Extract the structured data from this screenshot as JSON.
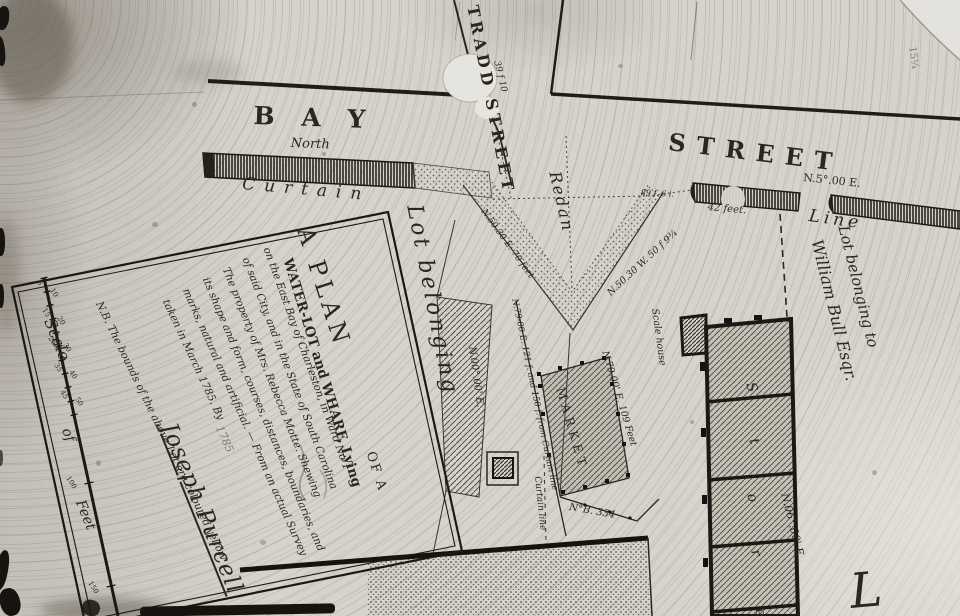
{
  "streets": {
    "bay": "B A Y",
    "bay_north": "North",
    "street": "STREET",
    "tradd": "TRADD STREET",
    "tradd_dim": "39 f 10",
    "curtain": "Curtain",
    "redan": "Redan",
    "line_word": "Line"
  },
  "bearings": {
    "n5e": "N.5°.00 E.",
    "feet42": "42 feet.",
    "feet89": "89 f. 6 i.",
    "redan_left": "N.50.30 E. 70 feet",
    "redan_right": "N.50.30 W. 50 f 9¾",
    "n79_121": "N.79-00 E. 121 f. and 150 f. from Curtain line",
    "n0": "N.00°.00' E.",
    "n79_109": "N.79.00' E. 109 Feet",
    "nb334": "N°B. 334",
    "n6e": "N.06°.00' E.",
    "curtain_line": "Curtain line"
  },
  "lots": {
    "lot_belonging": "Lot belonging",
    "william_1": "Lot belonging to",
    "william_2": "William Bull Esqr.",
    "market": "MARKET",
    "scale_house": "Scale house",
    "store_letters": [
      "S",
      "t",
      "o",
      "r",
      "e"
    ],
    "big_letter": "L"
  },
  "cartouche": {
    "title": "A PLAN",
    "title2": "OF A",
    "line2": "WATER-LOT and WHARF, Lying",
    "line3": "on the East Bay of Charleston, in Ward No 1",
    "line4": "of said City, and in the State of South Carolina",
    "line5": "The property of Mrs. Rebecca Motte. Shewing",
    "line6": "its shape and form, courses, distances, boundaries, and",
    "line7": "marks, natural and artificial. — From an actual Survey",
    "line8": "taken in March 1785. By",
    "signature": "Joseph Purcell",
    "note": "N.B. The bounds of the above Lot are coloured yellow",
    "scale_word1": "Scale",
    "scale_word2": "of",
    "scale_word3": "Feet",
    "scale_ticks": [
      "5",
      "10",
      "15",
      "20",
      "25",
      "30",
      "35",
      "40",
      "45",
      "50"
    ],
    "scale_100": "100",
    "scale_150": "150"
  },
  "pencil": {
    "corner_mark": "15¼",
    "year": "1785"
  },
  "colors": {
    "paper": "#d7d3cc",
    "ink": "#2b2720",
    "heavy_ink": "#15130f"
  }
}
